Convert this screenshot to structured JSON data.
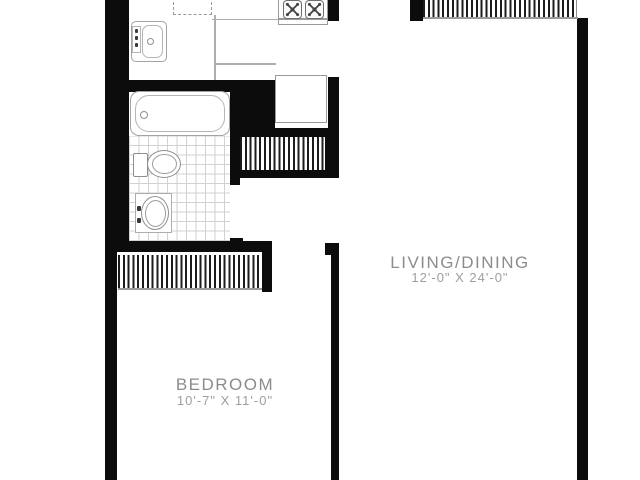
{
  "plan": {
    "type": "apartment-floor-plan",
    "colors": {
      "background": "#ffffff",
      "walls": "#0c0c0c",
      "fixture_lines": "#a3a3a3",
      "room_name_text": "#8c8c8c",
      "room_dims_text": "#9e9e9e"
    },
    "rooms": [
      {
        "id": "living_dining",
        "name": "LIVING/DINING",
        "dimensions": "12'-0\" X 24'-0\""
      },
      {
        "id": "bedroom",
        "name": "BEDROOM",
        "dimensions": "10'-7\" X 11'-0\""
      }
    ],
    "fixtures": [
      {
        "name": "kitchen-sink"
      },
      {
        "name": "upper-cabinet-dashed"
      },
      {
        "name": "stove-four-burner"
      },
      {
        "name": "refrigerator"
      },
      {
        "name": "kitchen-counter"
      },
      {
        "name": "bathtub"
      },
      {
        "name": "toilet"
      },
      {
        "name": "pedestal-sink"
      },
      {
        "name": "bathroom-tile-floor"
      },
      {
        "name": "closet-hatched-top-right"
      },
      {
        "name": "closet-hatched-hall"
      },
      {
        "name": "closet-hatched-bedroom"
      }
    ]
  }
}
